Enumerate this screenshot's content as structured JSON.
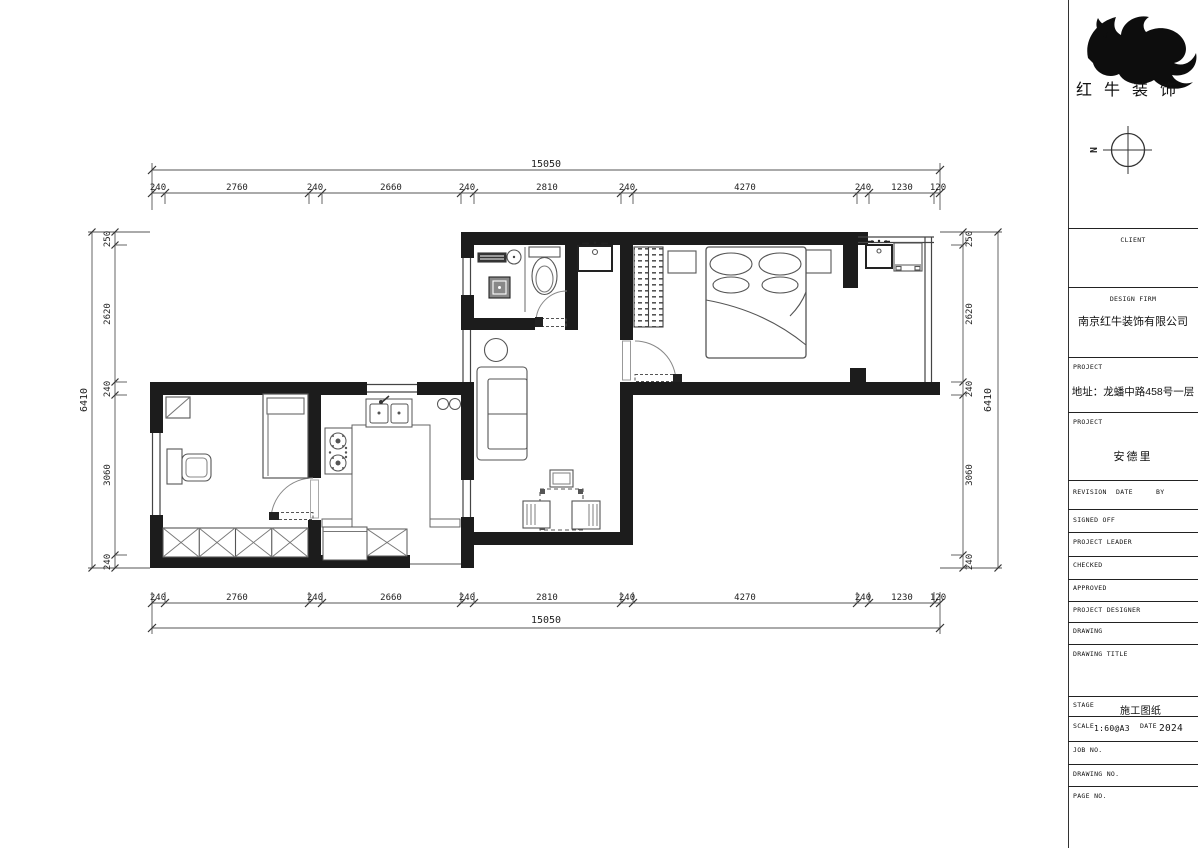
{
  "logo": {
    "brand": "红牛装饰"
  },
  "compass": {
    "label": "N"
  },
  "dimensions": {
    "h_total": "15050",
    "h_segments": [
      "240",
      "2760",
      "240",
      "2660",
      "240",
      "2810",
      "240",
      "4270",
      "240",
      "1230",
      "120"
    ],
    "v_total": "6410",
    "v_segments": [
      "250",
      "2620",
      "240",
      "3060",
      "240"
    ]
  },
  "title_block": {
    "client_label": "CLIENT",
    "design_firm_label": "DESIGN FIRM",
    "design_firm_name": "南京红牛装饰有限公司",
    "project_label": "PROJECT",
    "project_address": "地址：龙蟠中路458号一层",
    "project_label2": "PROJECT",
    "project_name": "安德里",
    "revision_label": "REVISION",
    "date_label": "DATE",
    "by_label": "BY",
    "signed_off_label": "SIGNED OFF",
    "project_leader_label": "PROJECT LEADER",
    "checked_label": "CHECKED",
    "approved_label": "APPROVED",
    "project_designer_label": "PROJECT DESIGNER",
    "drawing_label": "DRAWING",
    "drawing_title_label": "DRAWING TITLE",
    "stage_label": "STAGE",
    "stage_value": "施工图纸",
    "scale_label": "SCALE",
    "scale_value": "1:60@A3",
    "date2_label": "DATE",
    "date_value": "2024",
    "job_no_label": "JOB NO.",
    "drawing_no_label": "DRAWING NO.",
    "page_no_label": "PAGE NO."
  }
}
